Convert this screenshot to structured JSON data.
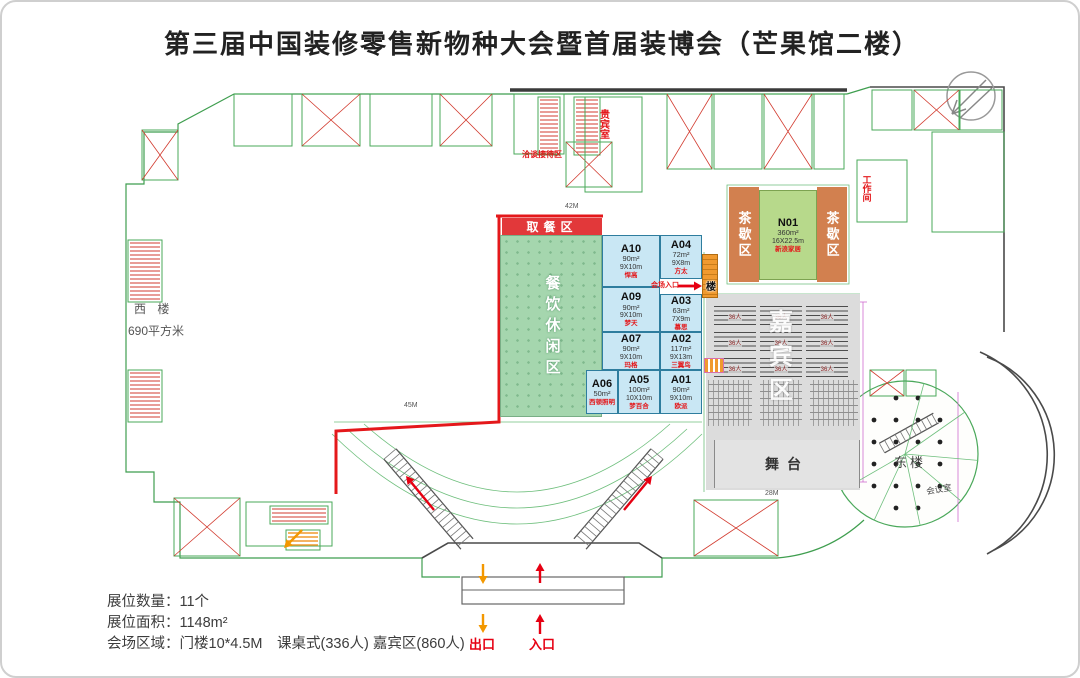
{
  "title": "第三届中国装修零售新物种大会暨首届装博会（芒果馆二楼）",
  "icons": {
    "compass": "compass-northwest-arrow",
    "exit_arrow": "orange-down-arrow",
    "entrance_arrow": "red-up-arrow",
    "escalator_arrows": "red-diagonal-arrows",
    "venue_entry_arrow": "red-right-arrow"
  },
  "plan": {
    "zones": {
      "food_pickup": "取餐区",
      "dining_lounge": "餐饮休闲区",
      "tea_break": "茶歇区",
      "guest_watermark": "嘉宾区"
    },
    "rooms": {
      "vip_room": "贵宾室",
      "reception": "洽谈接待区",
      "work_room": "工作间",
      "west_building": "西 楼",
      "west_building_area": "690平方米",
      "east_building": "东楼",
      "meeting_room": "会议室",
      "stage": "舞台",
      "stairs_char": "楼",
      "venue_entry": "会场入口"
    },
    "dims": {
      "top": "42M",
      "left_bottom": "45M",
      "stage": "28M"
    },
    "desk_block_label": "36人",
    "exit_label": "出口",
    "entrance_label": "入口"
  },
  "booths": [
    {
      "code": "N01",
      "area": "360m²",
      "size": "16X22.5m",
      "label": "新浪家居"
    },
    {
      "code": "A10",
      "area": "90m²",
      "size": "9X10m",
      "label": "悍高"
    },
    {
      "code": "A09",
      "area": "90m²",
      "size": "9X10m",
      "label": "梦天"
    },
    {
      "code": "A07",
      "area": "90m²",
      "size": "9X10m",
      "label": "玛格"
    },
    {
      "code": "A06",
      "area": "50m²",
      "size": "",
      "label": "西顿照明"
    },
    {
      "code": "A05",
      "area": "100m²",
      "size": "10X10m",
      "label": "梦百合"
    },
    {
      "code": "A04",
      "area": "72m²",
      "size": "9X8m",
      "label": "方太"
    },
    {
      "code": "A03",
      "area": "63m²",
      "size": "7X9m",
      "label": "慕思"
    },
    {
      "code": "A02",
      "area": "117m²",
      "size": "9X13m",
      "label": "三翼鸟"
    },
    {
      "code": "A01",
      "area": "90m²",
      "size": "9X10m",
      "label": "欧派"
    }
  ],
  "legend": {
    "line1": "展位数量：11个",
    "line2": "展位面积：1148m²",
    "line3": "会场区域：门楼10*4.5M　课桌式(336人) 嘉宾区(860人)"
  },
  "colors": {
    "accent_red": "#e4181b",
    "booth_blue": "#c9e7f4",
    "dining_green": "#a5d6ae",
    "tea_orange": "#d2804f",
    "n01_green": "#b7d98b",
    "seating_gray": "#dcdcdc",
    "exit_orange": "#f09a2f",
    "cad_green": "#3f9e4f"
  }
}
